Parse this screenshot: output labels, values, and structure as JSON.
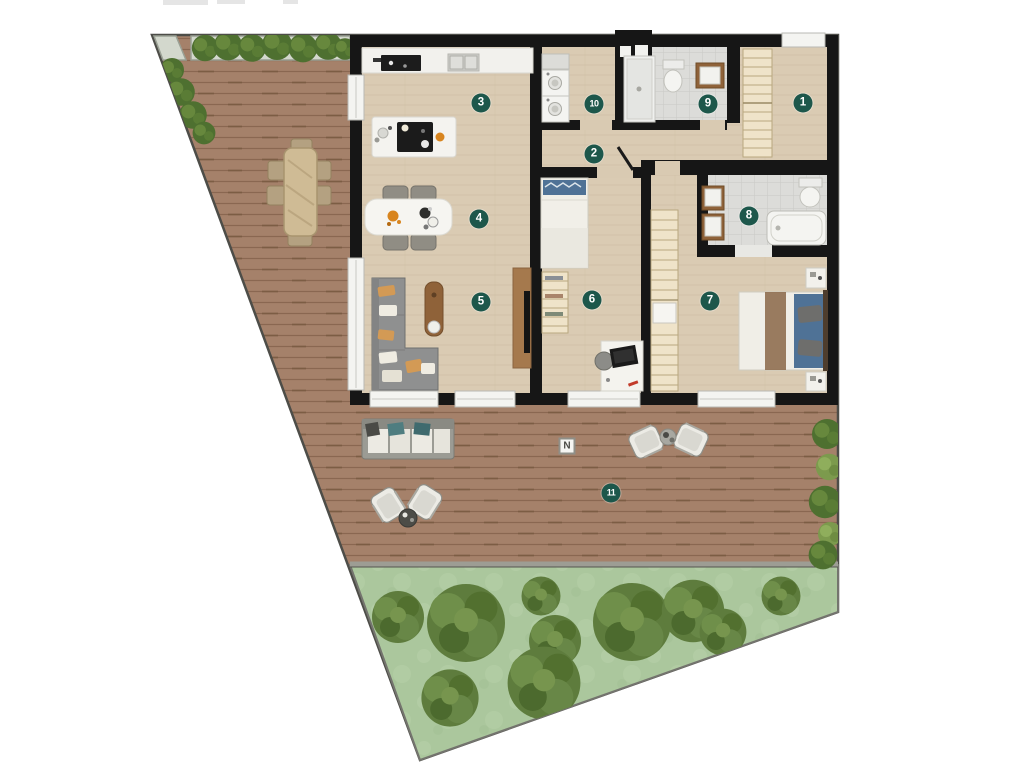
{
  "floorplan": {
    "room_markers": [
      {
        "number": "1"
      },
      {
        "number": "2"
      },
      {
        "number": "3"
      },
      {
        "number": "4"
      },
      {
        "number": "5"
      },
      {
        "number": "6"
      },
      {
        "number": "7"
      },
      {
        "number": "8"
      },
      {
        "number": "9"
      },
      {
        "number": "10"
      },
      {
        "number": "11"
      }
    ],
    "north_label": "N",
    "palette": {
      "marker": "#1d574b",
      "marker_text": "#ffffff",
      "wall": "#161616",
      "interior_floor": "#d9cab2",
      "bathroom_tile": "#dcdcd9",
      "deck_wood": "#a5816a",
      "grass": "#abc79d",
      "tree": "#5e7c3d",
      "hedge": "#4e7030",
      "teal_cushion": "#4f7d80",
      "bed_blue": "#4f7296",
      "wood_furniture": "#8f6239"
    }
  }
}
